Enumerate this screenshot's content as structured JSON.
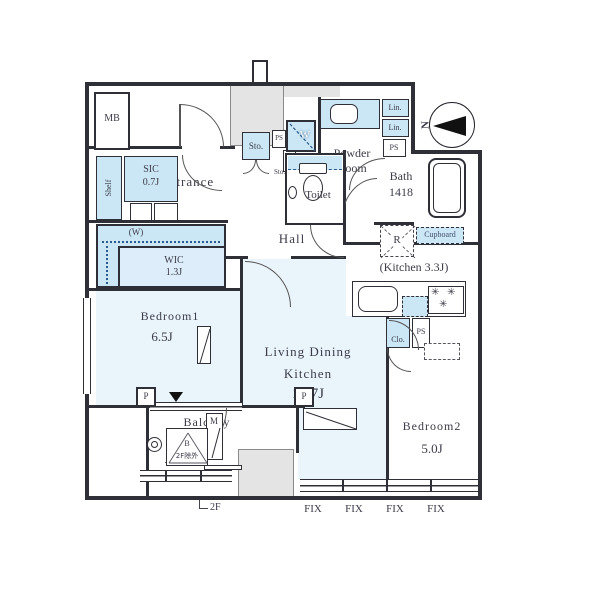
{
  "colors": {
    "wall": "#2f2f38",
    "room_fill": "#e9f4fb",
    "closet_fill": "#cbe6f5",
    "common_gray": "#e4e4e4",
    "text": "#3c3c49"
  },
  "labels": {
    "mb": "MB",
    "entrance": "Entrance",
    "shelf": "Shelf",
    "sic_line1": "SIC",
    "sic_line2": "0.7J",
    "hanger_w": "(W)",
    "wic_line1": "WIC",
    "wic_line2": "1.3J",
    "bedroom1": "Bedroom1",
    "bedroom1_size": "6.5J",
    "hall": "Hall",
    "toilet": "Toilet",
    "powder_line1": "Powder",
    "powder_line2": "Room",
    "bath": "Bath",
    "bath_size": "1418",
    "sto_large": "Sto.",
    "sto_small": "Sto.",
    "ps_top": "PS",
    "ps_powder": "PS",
    "ps_kitchen": "PS",
    "washer": "W",
    "lin1": "Lin.",
    "lin2": "Lin.",
    "fridge": "R",
    "cupboard": "Cupboard",
    "kitchen": "(Kitchen 3.3J)",
    "clo": "Clo.",
    "ldk_line1": "Living Dining",
    "ldk_line2": "Kitchen",
    "ldk_size": "13.7J",
    "bedroom2": "Bedroom2",
    "bedroom2_size": "5.0J",
    "balcony": "Balcony",
    "hatch_b": "B",
    "hatch_note": "2F除外",
    "meter_m": "M",
    "pillar1": "P",
    "pillar2": "P",
    "floor_note": "2F",
    "compass_n": "N"
  },
  "fix_labels": [
    "FIX",
    "FIX",
    "FIX",
    "FIX"
  ]
}
